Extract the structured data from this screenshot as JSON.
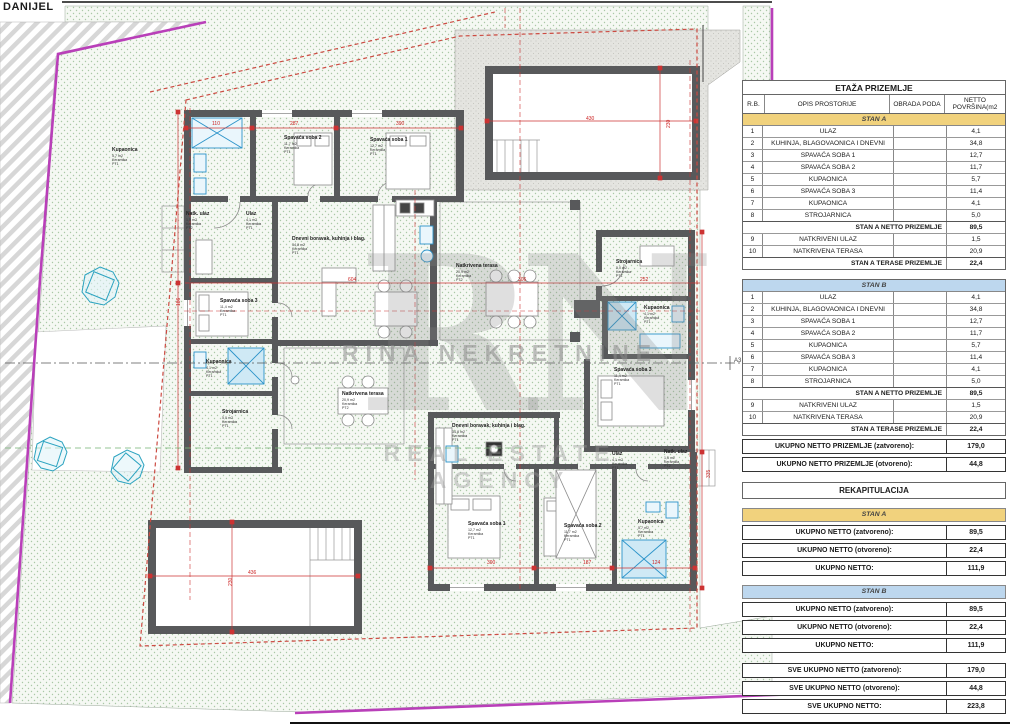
{
  "page": {
    "label": "DANIJEL"
  },
  "watermark": {
    "monogram": "RN",
    "line1": "RINA NEKRETNINE",
    "line2": "REAL ESTATE AGENCY"
  },
  "plan": {
    "section_label": "A3",
    "rooms": [
      {
        "name": "Kupaonica",
        "area": "5,7 m2",
        "floor": "Keramika",
        "code": "PT1",
        "x": 112,
        "y": 148
      },
      {
        "name": "Spavaća soba 2",
        "area": "11,7 m2",
        "floor": "Keramika",
        "code": "PT1",
        "x": 284,
        "y": 136
      },
      {
        "name": "Spavaća soba 1",
        "area": "12,7 m2",
        "floor": "Keramika",
        "code": "PT1",
        "x": 370,
        "y": 138
      },
      {
        "name": "Natk. ulaz",
        "area": "1,5 m2",
        "floor": "Keramika",
        "code": "PT2",
        "x": 186,
        "y": 212
      },
      {
        "name": "Ulaz",
        "area": "4,1 m2",
        "floor": "Keramika",
        "code": "PT1",
        "x": 246,
        "y": 212
      },
      {
        "name": "Dnevni boravak, kuhinja i blag.",
        "area": "34,8 m2",
        "floor": "Keramika",
        "code": "PT1",
        "x": 292,
        "y": 237
      },
      {
        "name": "Natkrivena terasa",
        "area": "20,9 m2",
        "floor": "Keramika",
        "code": "PT2",
        "x": 456,
        "y": 264
      },
      {
        "name": "Spavaća soba 3",
        "area": "11,4 m2",
        "floor": "Keramika",
        "code": "PT1",
        "x": 220,
        "y": 299
      },
      {
        "name": "Kupaonica",
        "area": "4,1 m2",
        "floor": "Keramika",
        "code": "PT1",
        "x": 206,
        "y": 360
      },
      {
        "name": "Strojarnica",
        "area": "5,0 m2",
        "floor": "Keramika",
        "code": "PT1",
        "x": 222,
        "y": 410
      },
      {
        "name": "Strojarnica",
        "area": "5,0 m2",
        "floor": "Keramika",
        "code": "PT1",
        "x": 616,
        "y": 260
      },
      {
        "name": "Kupaonica",
        "area": "4,1 m2",
        "floor": "Keramika",
        "code": "PT1",
        "x": 644,
        "y": 306
      },
      {
        "name": "Spavaća soba 3",
        "area": "11,4 m2",
        "floor": "Keramika",
        "code": "PT1",
        "x": 614,
        "y": 368
      },
      {
        "name": "Natkrivena terasa",
        "area": "20,9 m2",
        "floor": "Keramika",
        "code": "PT2",
        "x": 342,
        "y": 392
      },
      {
        "name": "Dnevni boravak, kuhinja i blag.",
        "area": "34,8 m2",
        "floor": "Keramika",
        "code": "PT1",
        "x": 452,
        "y": 424
      },
      {
        "name": "Ulaz",
        "area": "4,1 m2",
        "floor": "Keramika",
        "code": "PT1",
        "x": 612,
        "y": 452
      },
      {
        "name": "Natk. ulaz",
        "area": "1,5 m2",
        "floor": "Keramika",
        "code": "PT2",
        "x": 664,
        "y": 450
      },
      {
        "name": "Spavaća soba 1",
        "area": "12,7 m2",
        "floor": "Keramika",
        "code": "PT1",
        "x": 468,
        "y": 522
      },
      {
        "name": "Spavaća soba 2",
        "area": "11,7 m2",
        "floor": "Keramika",
        "code": "PT1",
        "x": 564,
        "y": 524
      },
      {
        "name": "Kupaonica",
        "area": "5,7 m2",
        "floor": "Keramika",
        "code": "PT1",
        "x": 638,
        "y": 520
      }
    ],
    "dims": [
      {
        "t": "110",
        "x": 212,
        "y": 121
      },
      {
        "t": "287",
        "x": 290,
        "y": 121
      },
      {
        "t": "390",
        "x": 396,
        "y": 121
      },
      {
        "t": "430",
        "x": 586,
        "y": 116
      },
      {
        "t": "230",
        "x": 666,
        "y": 128,
        "rot": -90
      },
      {
        "t": "436",
        "x": 248,
        "y": 570
      },
      {
        "t": "230",
        "x": 228,
        "y": 586,
        "rot": -90
      },
      {
        "t": "390",
        "x": 487,
        "y": 560
      },
      {
        "t": "187",
        "x": 583,
        "y": 560
      },
      {
        "t": "124",
        "x": 652,
        "y": 560
      },
      {
        "t": "252",
        "x": 640,
        "y": 277
      },
      {
        "t": "186",
        "x": 176,
        "y": 306,
        "rot": -90
      },
      {
        "t": "335",
        "x": 706,
        "y": 478,
        "rot": -90
      },
      {
        "t": "604",
        "x": 348,
        "y": 277
      },
      {
        "t": "306",
        "x": 518,
        "y": 277
      }
    ]
  },
  "table": {
    "title": "ETAŽA PRIZEMLJE",
    "columns": {
      "rb": "R.B.",
      "opis": "OPIS PROSTORIJE",
      "obrada": "OBRADA PODA",
      "netto1": "NETTO",
      "netto2": "POVRŠINA(m2"
    },
    "stanA": {
      "band": "STAN A",
      "rows": [
        {
          "n": "1",
          "label": "ULAZ",
          "value": "4,1"
        },
        {
          "n": "2",
          "label": "KUHINJA, BLAGOVAONICA I DNEVNI",
          "value": "34,8"
        },
        {
          "n": "3",
          "label": "SPAVAĆA SOBA 1",
          "value": "12,7"
        },
        {
          "n": "4",
          "label": "SPAVAĆA SOBA 2",
          "value": "11,7"
        },
        {
          "n": "5",
          "label": "KUPAONICA",
          "value": "5,7"
        },
        {
          "n": "6",
          "label": "SPAVAĆA SOBA 3",
          "value": "11,4"
        },
        {
          "n": "7",
          "label": "KUPAONICA",
          "value": "4,1"
        },
        {
          "n": "8",
          "label": "STROJARNICA",
          "value": "5,0"
        }
      ],
      "net": {
        "label": "STAN A NETTO PRIZEMLJE",
        "value": "89,5"
      },
      "rows2": [
        {
          "n": "9",
          "label": "NATKRIVENI ULAZ",
          "value": "1,5"
        },
        {
          "n": "10",
          "label": "NATKRIVENA TERASA",
          "value": "20,9"
        }
      ],
      "terrace": {
        "label": "STAN A TERASE PRIZEMLJE",
        "value": "22,4"
      }
    },
    "stanB": {
      "band": "STAN B",
      "rows": [
        {
          "n": "1",
          "label": "ULAZ",
          "value": "4,1"
        },
        {
          "n": "2",
          "label": "KUHINJA, BLAGOVAONICA I DNEVNI",
          "value": "34,8"
        },
        {
          "n": "3",
          "label": "SPAVAĆA SOBA 1",
          "value": "12,7"
        },
        {
          "n": "4",
          "label": "SPAVAĆA SOBA 2",
          "value": "11,7"
        },
        {
          "n": "5",
          "label": "KUPAONICA",
          "value": "5,7"
        },
        {
          "n": "6",
          "label": "SPAVAĆA SOBA 3",
          "value": "11,4"
        },
        {
          "n": "7",
          "label": "KUPAONICA",
          "value": "4,1"
        },
        {
          "n": "8",
          "label": "STROJARNICA",
          "value": "5,0"
        }
      ],
      "net": {
        "label": "STAN A NETTO PRIZEMLJE",
        "value": "89,5"
      },
      "rows2": [
        {
          "n": "9",
          "label": "NATKRIVENI ULAZ",
          "value": "1,5"
        },
        {
          "n": "10",
          "label": "NATKRIVENA TERASA",
          "value": "20,9"
        }
      ],
      "terrace": {
        "label": "STAN A TERASE PRIZEMLJE",
        "value": "22,4"
      }
    },
    "totals": [
      {
        "label": "UKUPNO NETTO PRIZEMLJE (zatvoreno):",
        "value": "179,0"
      },
      {
        "label": "UKUPNO NETTO PRIZEMLJE (otvoreno):",
        "value": "44,8"
      }
    ],
    "rekap": {
      "title": "REKAPITULACIJA",
      "stanA": {
        "band": "STAN A",
        "rows": [
          {
            "label": "UKUPNO NETTO  (zatvoreno):",
            "value": "89,5"
          },
          {
            "label": "UKUPNO NETTO  (otvoreno):",
            "value": "22,4"
          },
          {
            "label": "UKUPNO NETTO:",
            "value": "111,9"
          }
        ]
      },
      "stanB": {
        "band": "STAN B",
        "rows": [
          {
            "label": "UKUPNO NETTO  (zatvoreno):",
            "value": "89,5"
          },
          {
            "label": "UKUPNO NETTO  (otvoreno):",
            "value": "22,4"
          },
          {
            "label": "UKUPNO NETTO:",
            "value": "111,9"
          }
        ]
      },
      "sve": [
        {
          "label": "SVE UKUPNO NETTO  (zatvoreno):",
          "value": "179,0"
        },
        {
          "label": "SVE UKUPNO NETTO  (otvoreno):",
          "value": "44,8"
        },
        {
          "label": "SVE UKUPNO NETTO:",
          "value": "223,8"
        }
      ]
    }
  },
  "colors": {
    "parcel_boundary": "#b93fb9",
    "setback_line": "#cc4b42",
    "dimension": "#cc3333",
    "walls": "#58595b",
    "band_stan_a": "#f1d27d",
    "band_stan_b": "#bdd7ee",
    "greenery_dot": "#aac8a6",
    "fixture_blue": "#2b93c9"
  }
}
